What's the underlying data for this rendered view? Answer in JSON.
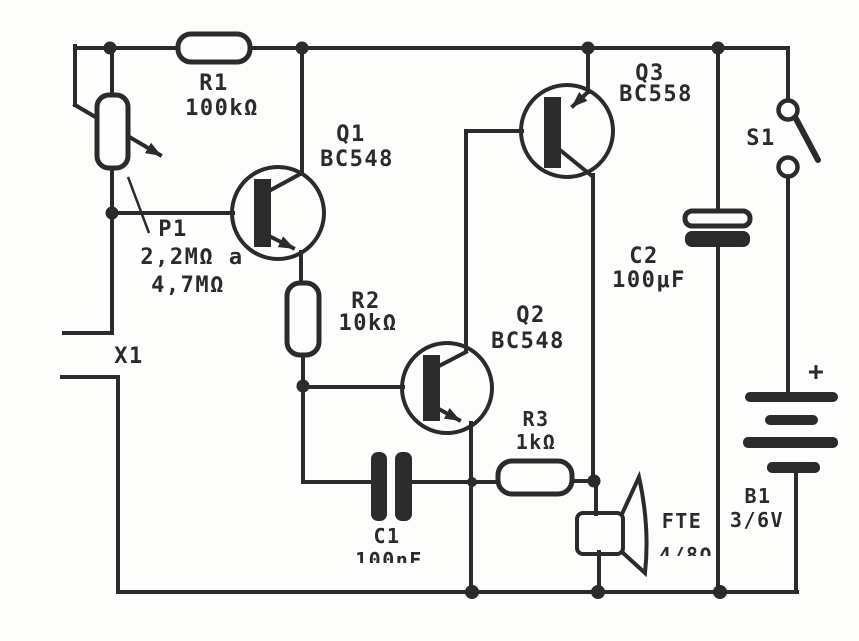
{
  "figure": {
    "type": "circuit-schematic",
    "ink_color": "#2b2b2b",
    "paper_color": "#fdfdfb"
  },
  "components": {
    "R1": {
      "ref": "R1",
      "value": "100kΩ"
    },
    "P1": {
      "ref": "P1",
      "value_line1": "2,2MΩ a",
      "value_line2": "4,7MΩ"
    },
    "X1": {
      "ref": "X1"
    },
    "Q1": {
      "ref": "Q1",
      "part": "BC548"
    },
    "Q2": {
      "ref": "Q2",
      "part": "BC548"
    },
    "Q3": {
      "ref": "Q3",
      "part": "BC558"
    },
    "R2": {
      "ref": "R2",
      "value": "10kΩ"
    },
    "R3": {
      "ref": "R3",
      "value": "1kΩ"
    },
    "C1": {
      "ref": "C1",
      "value": "100nF"
    },
    "C2": {
      "ref": "C2",
      "value": "100μF"
    },
    "S1": {
      "ref": "S1"
    },
    "B1": {
      "ref": "B1",
      "value": "3/6V",
      "polarity": "+"
    },
    "FTE": {
      "ref": "FTE",
      "value": "4/8Ω"
    }
  }
}
